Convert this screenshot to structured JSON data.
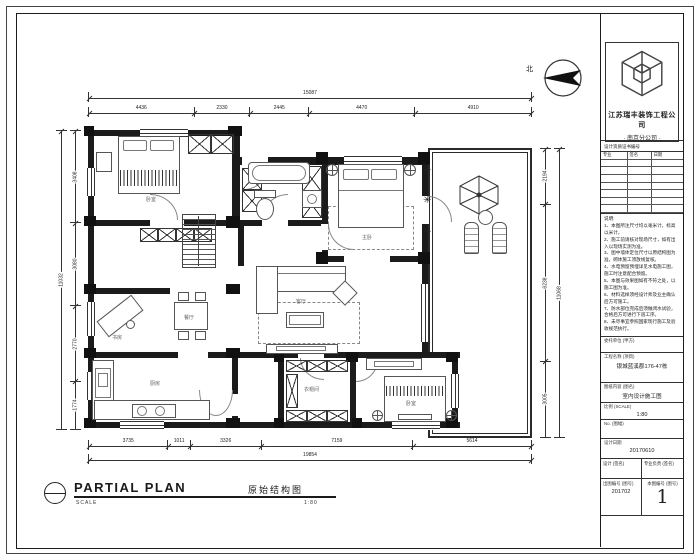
{
  "north_label": "北",
  "plan": {
    "dims_top": [
      "4436",
      "2330",
      "2445",
      "4470",
      "4910"
    ],
    "dims_top_total": "15087",
    "dims_bottom": [
      "3735",
      "1011",
      "3326",
      "7159",
      "5614"
    ],
    "dims_bottom_total": "19854",
    "dims_left": [
      "3408",
      "3080",
      "2770",
      "1774"
    ],
    "dims_left_total": "11032",
    "dims_right": [
      "2194",
      "6238",
      "3005"
    ],
    "dims_right_total": "11068",
    "rooms": [
      "卧室",
      "主卧",
      "客厅",
      "餐厅",
      "厨房",
      "书房",
      "衣帽间",
      "卧室"
    ]
  },
  "footer": {
    "title": "PARTIAL PLAN",
    "scale_word": "SCALE",
    "cn_title": "原始结构图",
    "scale_value": "1:80"
  },
  "title_block": {
    "company_line1": "江苏瑞丰装饰工程公司",
    "company_line2": "· 南京分公司 ·",
    "sign_strip": "设计资质证书编号",
    "sign_headers": [
      "专业",
      "签名",
      "日期"
    ],
    "notes_title": "说明:",
    "notes": [
      "1、本图所注尺寸均以毫米计，标高以米计。",
      "2、施工前请核对现场尺寸，如有出入以现场实测为准。",
      "3、图中墙体定位尺寸以原结构图为准，砌体施工须放线复核。",
      "4、水电预留预埋详见水电施工图，施工时注意配合预留。",
      "5、本图与效果图如有不符之处，以施工图为准。",
      "6、材料选样须经设计师及业主确认后方可施工。",
      "7、防水部位完成后须做闭水试验，合格后方可进行下道工序。",
      "8、未尽事宜参照国家现行施工及验收规范执行。"
    ],
    "fields": [
      {
        "label": "委托单位 (甲方)",
        "value": ""
      },
      {
        "label": "工程名称 (项目)",
        "value": "银城蓝溪郡176-47栋"
      },
      {
        "label": "图纸内容 (图名)",
        "value": "室内设计施工图"
      },
      {
        "label": "比例 (SCALE)",
        "value": "1:80"
      },
      {
        "label": "No. (图幅)",
        "value": ""
      },
      {
        "label": "设计日期",
        "value": "20170610"
      }
    ],
    "bottom": {
      "r1c1": "设计 (签名)",
      "r1c2": "专业负责 (签名)",
      "r2l_label": "出图编号 (图号)",
      "r2l_value": "201702",
      "r2r_label": "本图编号 (图号)",
      "sheet": "1"
    }
  }
}
